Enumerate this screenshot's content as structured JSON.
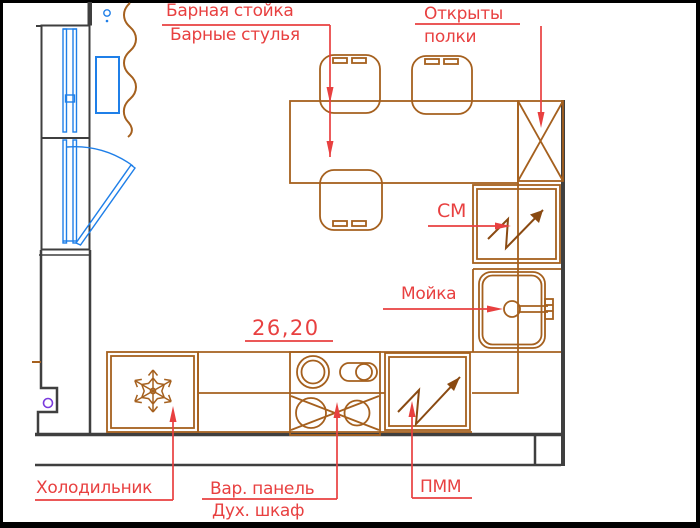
{
  "title": "Kitchen floor plan",
  "colors": {
    "label_red": "#e84040",
    "furniture_brown": "#a5601e",
    "arrow_dark_brown": "#8a4a12",
    "wall_gray": "#3f3f3f",
    "window_blue": "#1f7fe8",
    "outlet_purple": "#7a3bdd",
    "frame_black": "#000000"
  },
  "labels": {
    "bar_counter": "Барная стойка",
    "bar_stools": "Барные стулья",
    "open_shelves": {
      "line1": "Открыты",
      "line2": "полки"
    },
    "washing_machine": "СМ",
    "sink": "Мойка",
    "dimension": "26,20",
    "fridge": "Холодильник",
    "hob": "Вар. панель",
    "oven": "Дух. шкаф",
    "dishwasher": "ПММ"
  }
}
